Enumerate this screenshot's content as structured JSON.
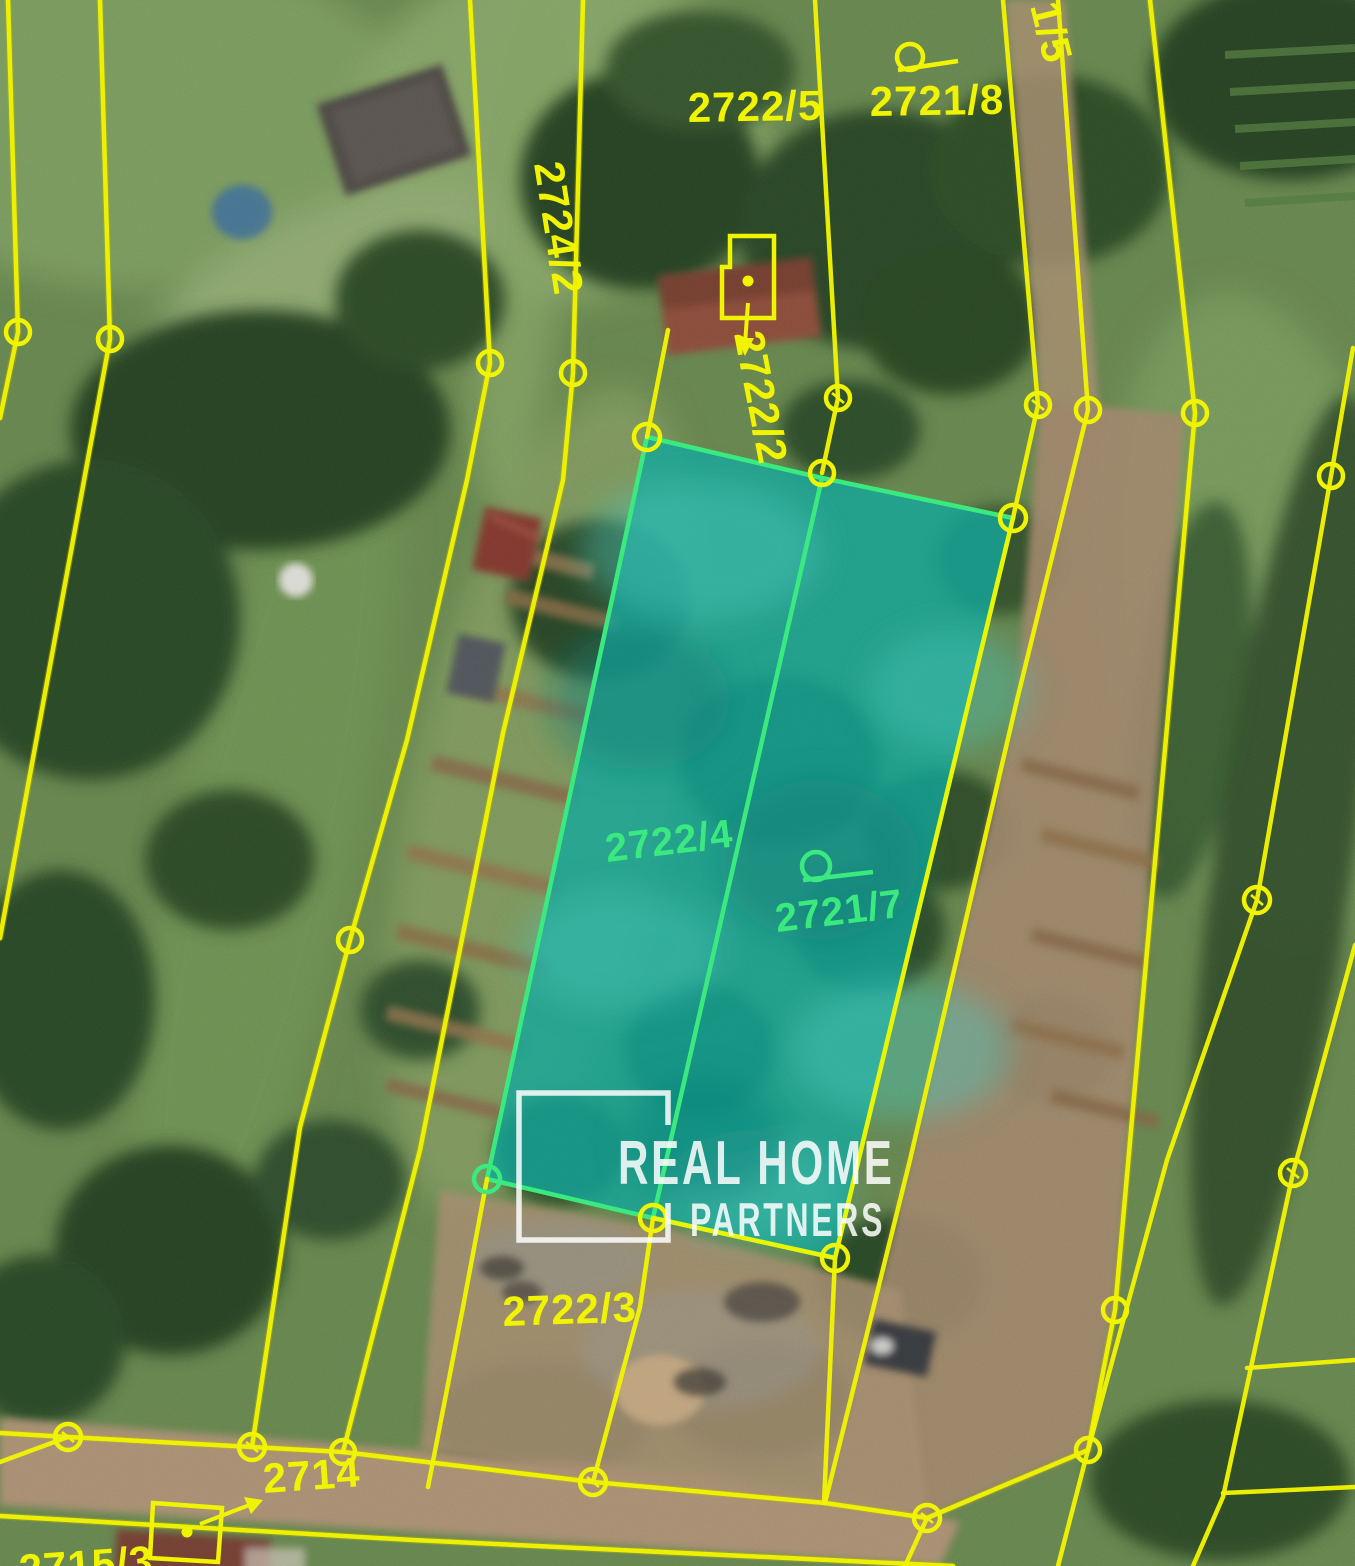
{
  "map": {
    "labels": {
      "p2722_5": "2722/5",
      "p2721_8": "2721/8",
      "p2721_5_partial": "1/5",
      "p2724_2": "2724/2",
      "p2722_2": "2722/2",
      "p2722_4": "2722/4",
      "p2721_7": "2721/7",
      "p2722_3": "2722/3",
      "p2714": "2714",
      "p2715_3": "2715/3"
    },
    "highlighted_parcels": [
      "2722/4",
      "2721/7"
    ],
    "colors": {
      "boundary_line": "#F1F400",
      "highlight_fill": "#13A79C",
      "highlight_outline": "#3BEA7F",
      "highlight_label": "#3BEA7F",
      "watermark": "#FFFFFF"
    }
  },
  "watermark": {
    "line1": "REAL HOME",
    "line2": "PARTNERS"
  }
}
